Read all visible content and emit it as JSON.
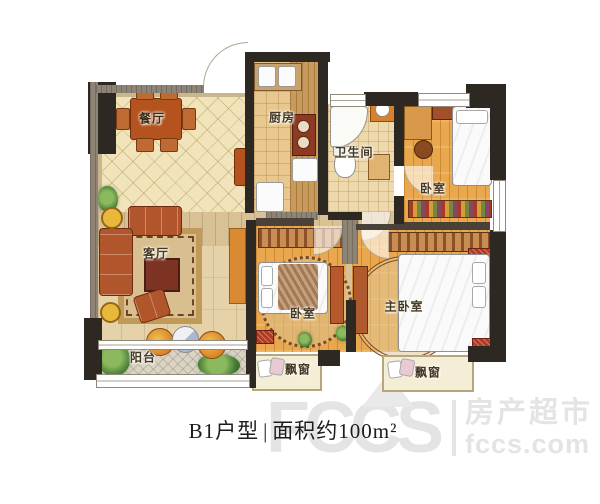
{
  "plan": {
    "rooms": {
      "dining": {
        "label": "餐厅"
      },
      "kitchen": {
        "label": "厨房"
      },
      "bathroom": {
        "label": "卫生间"
      },
      "bedroom_top": {
        "label": "卧室"
      },
      "living": {
        "label": "客厅"
      },
      "balcony": {
        "label": "阳台"
      },
      "bedroom_middle": {
        "label": "卧室"
      },
      "master_bedroom": {
        "label": "主卧室"
      },
      "bay_window_left": {
        "label": "飘窗"
      },
      "bay_window_right": {
        "label": "飘窗"
      }
    }
  },
  "caption": {
    "unit": "B1户型",
    "divider": "|",
    "area": "面积约100m²"
  },
  "watermark": {
    "letters": "FCCS",
    "brand": "房产超市",
    "domain": "fccs.com"
  },
  "colors": {
    "wall": "#2e2822",
    "wood_floor": "#e9a84d",
    "cream_floor": "#f2e4ba",
    "watermark_gray": "#e4e4e4"
  }
}
